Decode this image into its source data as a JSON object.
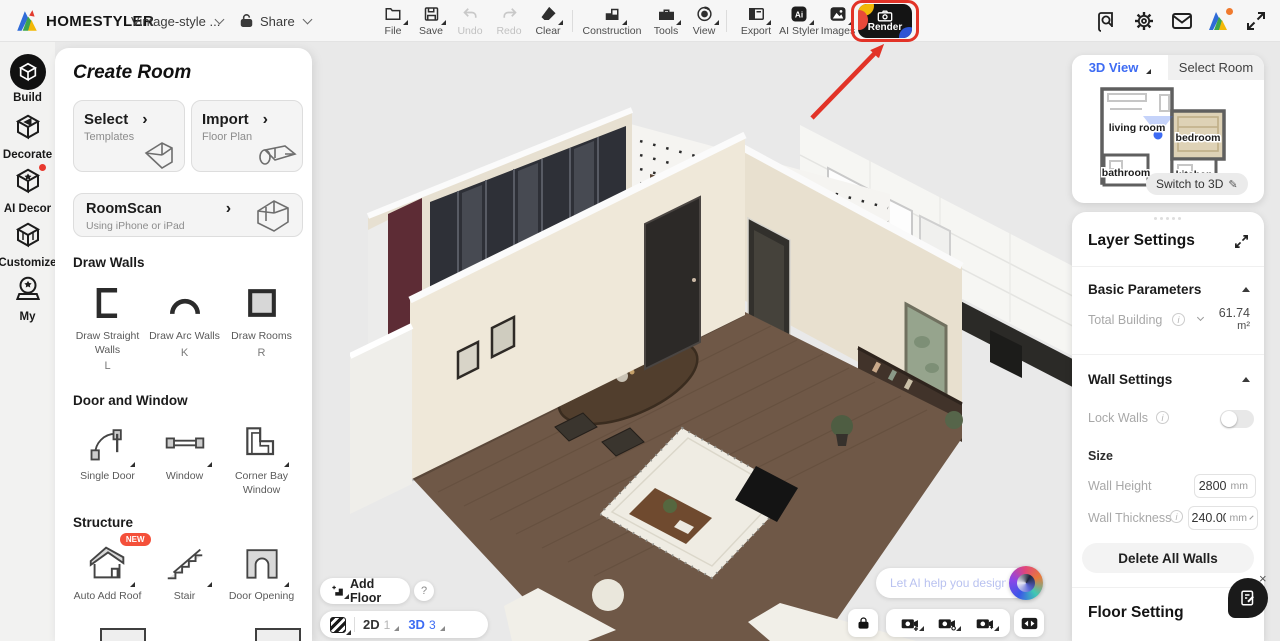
{
  "header": {
    "logo_text": "HOMESTYLER",
    "project_name": "Vintage-style ...",
    "share_label": "Share",
    "toolbar": {
      "items": [
        {
          "label": "File"
        },
        {
          "label": "Save"
        },
        {
          "label": "Undo"
        },
        {
          "label": "Redo"
        },
        {
          "label": "Clear"
        },
        {
          "label": "Construction"
        },
        {
          "label": "Tools"
        },
        {
          "label": "View"
        },
        {
          "label": "Export"
        },
        {
          "label": "AI Styler"
        },
        {
          "label": "Images"
        },
        {
          "label": "Render"
        }
      ]
    }
  },
  "rail": {
    "items": [
      {
        "label": "Build"
      },
      {
        "label": "Decorate"
      },
      {
        "label": "AI Decor"
      },
      {
        "label": "Customize"
      },
      {
        "label": "My"
      }
    ]
  },
  "create_room": {
    "title": "Create Room",
    "cards": {
      "select": {
        "title": "Select",
        "subtitle": "Templates"
      },
      "import": {
        "title": "Import",
        "subtitle": "Floor Plan"
      },
      "roomscan": {
        "title": "RoomScan",
        "subtitle": "Using iPhone or iPad"
      }
    },
    "chevron": "›",
    "draw_walls": {
      "title": "Draw Walls",
      "items": [
        {
          "label": "Draw Straight Walls",
          "shortcut": "L"
        },
        {
          "label": "Draw Arc Walls",
          "shortcut": "K"
        },
        {
          "label": "Draw Rooms",
          "shortcut": "R"
        }
      ]
    },
    "door_window": {
      "title": "Door and Window",
      "items": [
        {
          "label": "Single Door"
        },
        {
          "label": "Window"
        },
        {
          "label": "Corner Bay Window"
        }
      ]
    },
    "structure": {
      "title": "Structure",
      "new_badge": "NEW",
      "items": [
        {
          "label": "Auto Add Roof"
        },
        {
          "label": "Stair"
        },
        {
          "label": "Door Opening"
        }
      ]
    }
  },
  "viewcube": {
    "tab_3d": "3D View",
    "tab_select_room": "Select Room",
    "rooms": [
      "living room",
      "bedroom",
      "bathroom",
      "kitchen"
    ],
    "switch_label": "Switch to 3D"
  },
  "layer_settings": {
    "title": "Layer Settings",
    "basic": {
      "title": "Basic Parameters",
      "total_building": "Total Building",
      "value": "61.74",
      "unit": "m²"
    },
    "walls": {
      "title": "Wall Settings",
      "lock_walls": "Lock Walls",
      "size": "Size",
      "wall_height": "Wall Height",
      "wall_height_value": "2800",
      "wall_height_unit": "mm",
      "wall_thickness": "Wall Thickness",
      "wall_thickness_value": "240.00",
      "wall_thickness_unit": "mm",
      "delete_all": "Delete All Walls"
    },
    "floor": {
      "title": "Floor Setting"
    }
  },
  "bottom": {
    "add_floor": "Add Floor",
    "help": "?",
    "d2": "2D",
    "d2_count": "1",
    "d3": "3D",
    "d3_count": "3"
  },
  "ai": {
    "placeholder": "Let AI help you design"
  },
  "icons": {
    "switch_pencil": "✎",
    "close": "×",
    "info": "i",
    "ai_styler_text": "Ai"
  },
  "colors": {
    "accent_blue": "#3D6BF3",
    "highlight_red": "#E5332A",
    "badge_red": "#F4503A",
    "canvas": "#E9E9E9"
  }
}
